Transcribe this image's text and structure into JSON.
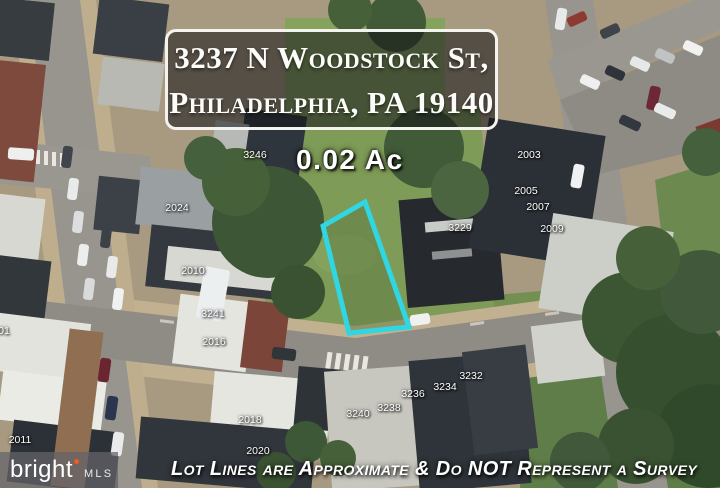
{
  "banner": {
    "line1": "3237 N Woodstock St,",
    "line2": "Philadelphia, PA 19140"
  },
  "lot": {
    "area_label": "0.02 Ac",
    "outline_color": "#30d6e2",
    "outline_points": "323,226 365,202 409,327 349,333"
  },
  "disclaimer": "Lot Lines are Approximate & Do NOT Represent a Survey",
  "logo": {
    "brand": "bright",
    "suffix": "MLS",
    "dot_color": "#f05a28"
  },
  "parcel_labels": [
    {
      "text": "3246",
      "x": 255,
      "y": 155
    },
    {
      "text": "2024",
      "x": 177,
      "y": 208
    },
    {
      "text": "2010",
      "x": 193,
      "y": 271
    },
    {
      "text": "3241",
      "x": 213,
      "y": 314
    },
    {
      "text": "2016",
      "x": 214,
      "y": 342
    },
    {
      "text": "2018",
      "x": 250,
      "y": 420
    },
    {
      "text": "2020",
      "x": 258,
      "y": 451
    },
    {
      "text": "3240",
      "x": 358,
      "y": 414
    },
    {
      "text": "3238",
      "x": 389,
      "y": 408
    },
    {
      "text": "3236",
      "x": 413,
      "y": 394
    },
    {
      "text": "3234",
      "x": 445,
      "y": 387
    },
    {
      "text": "3232",
      "x": 471,
      "y": 376
    },
    {
      "text": "3229",
      "x": 460,
      "y": 228
    },
    {
      "text": "2003",
      "x": 529,
      "y": 155
    },
    {
      "text": "2005",
      "x": 526,
      "y": 191
    },
    {
      "text": "2007",
      "x": 538,
      "y": 207
    },
    {
      "text": "2009",
      "x": 552,
      "y": 229
    },
    {
      "text": "2011",
      "x": 20,
      "y": 440
    },
    {
      "text": "01",
      "x": 4,
      "y": 331
    }
  ]
}
